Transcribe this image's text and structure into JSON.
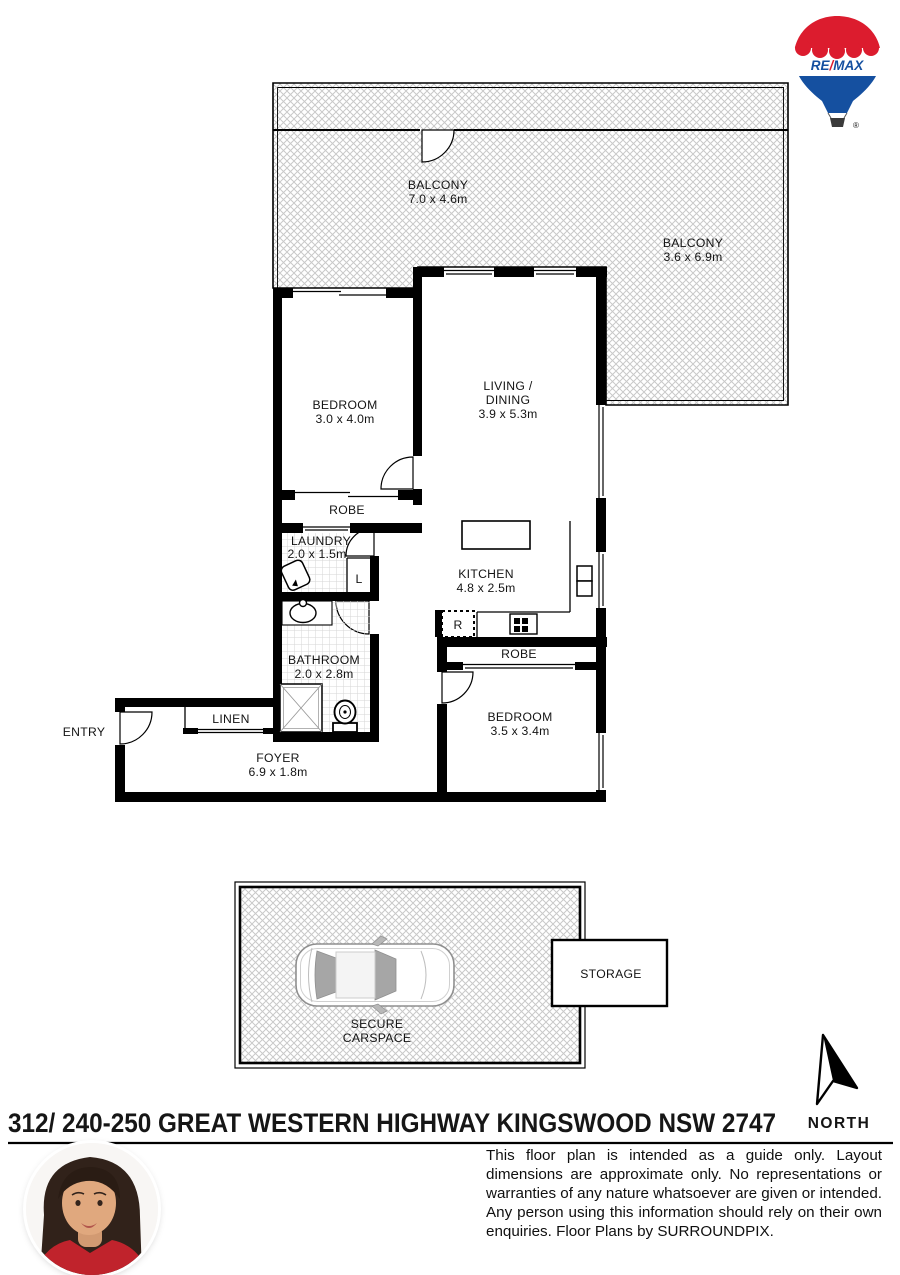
{
  "logo": {
    "re": "RE",
    "slash": "/",
    "max": "MAX",
    "registered": "®"
  },
  "plan": {
    "balcony_top": {
      "name": "BALCONY",
      "dims": "7.0 x 4.6m"
    },
    "balcony_right": {
      "name": "BALCONY",
      "dims": "3.6 x 6.9m"
    },
    "bedroom1": {
      "name": "BEDROOM",
      "dims": "3.0 x 4.0m"
    },
    "living": {
      "name1": "LIVING /",
      "name2": "DINING",
      "dims": "3.9 x 5.3m"
    },
    "robe1": {
      "name": "ROBE"
    },
    "laundry": {
      "name": "LAUNDRY",
      "dims": "2.0 x 1.5m"
    },
    "linen_cupboard": {
      "name": "L"
    },
    "kitchen": {
      "name": "KITCHEN",
      "dims": "4.8 x 2.5m"
    },
    "fridge": {
      "name": "R"
    },
    "bathroom": {
      "name": "BATHROOM",
      "dims": "2.0 x 2.8m"
    },
    "robe2": {
      "name": "ROBE"
    },
    "bedroom2": {
      "name": "BEDROOM",
      "dims": "3.5 x 3.4m"
    },
    "linen": {
      "name": "LINEN"
    },
    "entry": {
      "name": "ENTRY"
    },
    "foyer": {
      "name": "FOYER",
      "dims": "6.9 x 1.8m"
    },
    "carspace": {
      "name1": "SECURE",
      "name2": "CARSPACE"
    },
    "storage": {
      "name": "STORAGE"
    },
    "north": {
      "label": "NORTH"
    }
  },
  "footer": {
    "address": "312/ 240-250 GREAT WESTERN HIGHWAY KINGSWOOD NSW 2747",
    "disclaimer": "This floor plan is intended as a guide only. Layout dimensions are approximate only. No representations or warranties of any nature whatsoever are given or intended. Any person using this information should rely on their own enquiries. Floor Plans by SURROUNDPIX."
  },
  "colors": {
    "remax_red": "#DC1C2E",
    "remax_blue": "#1550A0",
    "wall": "#000000",
    "hatch": "#c9c9c9"
  }
}
